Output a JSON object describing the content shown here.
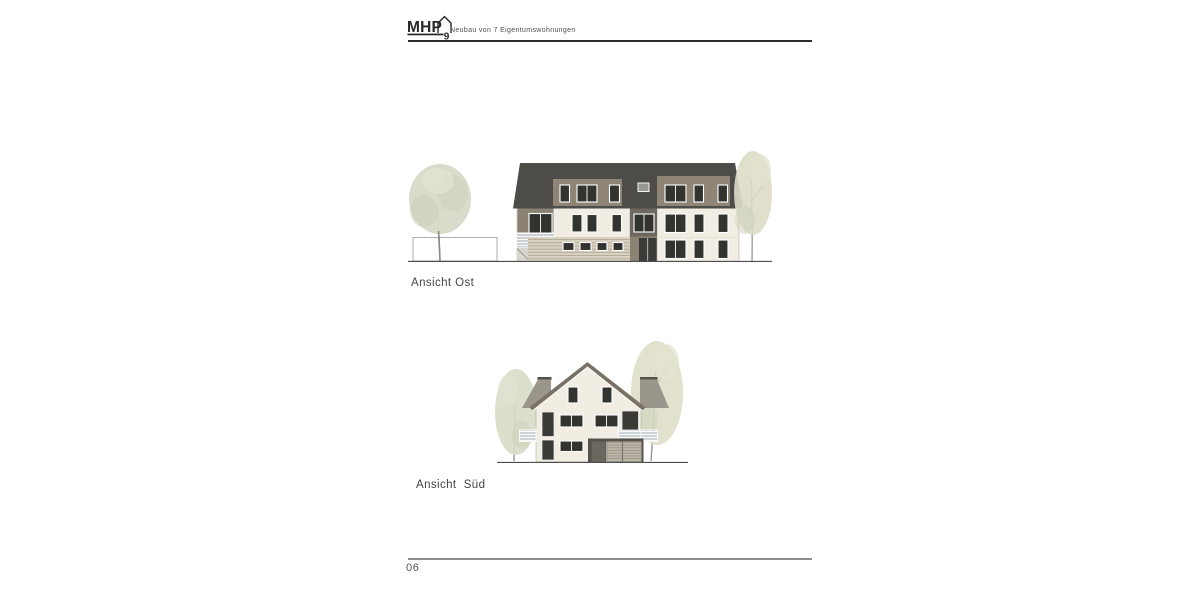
{
  "header": {
    "logo": {
      "text": "MHP",
      "number": "9",
      "icon": "house-outline-icon"
    },
    "subtitle": "Neubau von 7 Eigentumswohnungen"
  },
  "drawings": [
    {
      "label": "Ansicht Ost",
      "type": "building-elevation-east"
    },
    {
      "label": "Ansicht  Süd",
      "type": "building-elevation-south"
    }
  ],
  "footer": {
    "page_number": "06"
  },
  "colors": {
    "roof_dark": "#4d4c49",
    "dormer_taupe": "#8e8577",
    "facade_cream": "#f1ede2",
    "entrance_bay_gray": "#6e6760",
    "bay_taupe": "#8b8274",
    "window_glass": "#33332f",
    "window_frame": "#ffffff",
    "balcony_railing": "#cbd0d5",
    "siding_base": "#d8d1c1",
    "south_roof_band": "#7a7266",
    "background_roof": "#9b968b",
    "garage_frame": "#55524b",
    "garage_slats": "#bdb7aa",
    "tree_foliage": "#d7dac7",
    "ground_line": "#4c4c4c",
    "header_rule": "#2d2d2d",
    "footer_rule": "#8e8e8e",
    "label_text": "#454545"
  }
}
